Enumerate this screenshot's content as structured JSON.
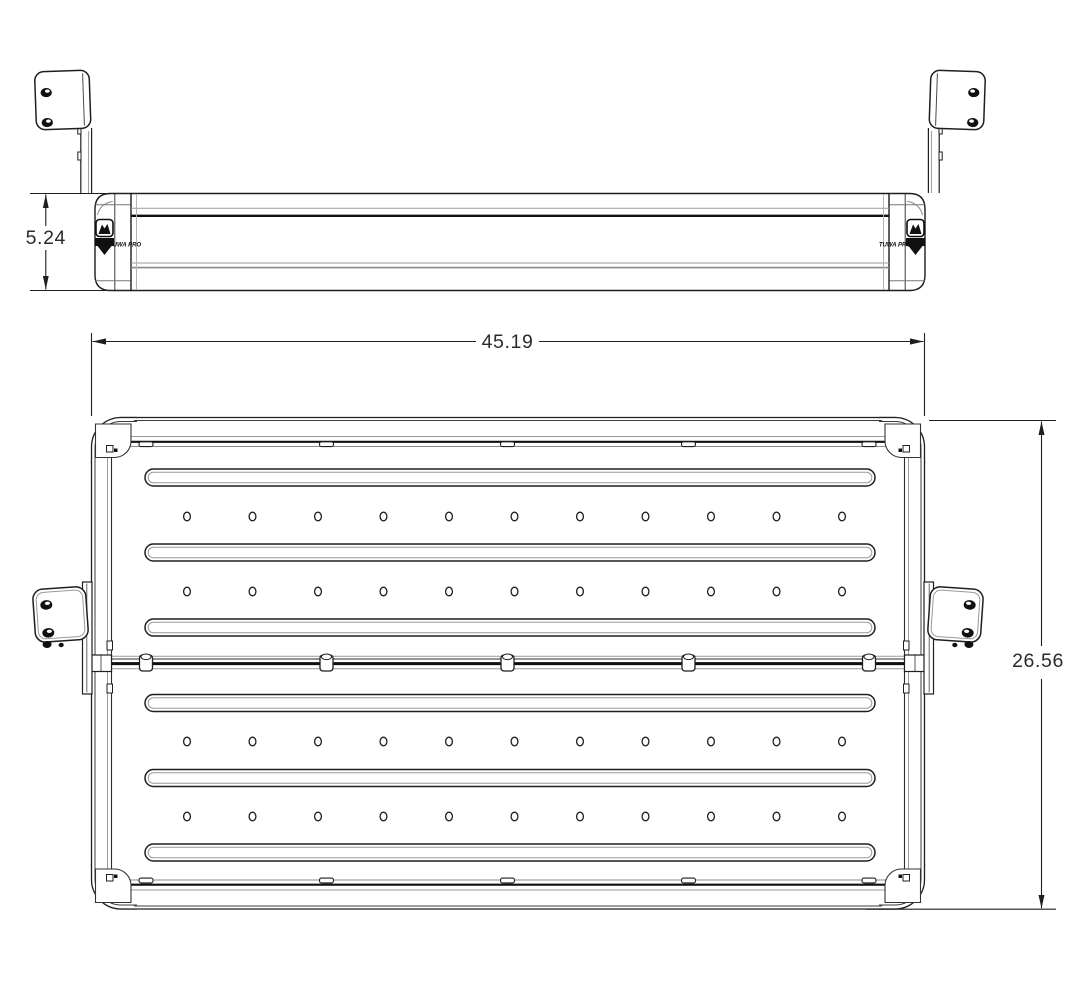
{
  "page": {
    "background_color": "#ffffff"
  },
  "palette": {
    "line": "#1f1f1f",
    "dark_line": "#0f0f0f",
    "light_line": "#9a9a9a",
    "text": "#2b2b2b"
  },
  "dimensions": {
    "crossbar_height_label": "5.24",
    "overall_width_label": "45.19",
    "overall_depth_label": "26.56"
  },
  "brand": {
    "logo_text": "TUWA PRO",
    "logo_icon": "mountain-shield-icon"
  },
  "front_view": {
    "mount_bracket_count": 2,
    "bracket_bolt_hole_count": 2,
    "end_cap_count": 2
  },
  "plan_view": {
    "slot_count": 6,
    "hole_row_count": 4,
    "holes_per_row": 11,
    "seam_clip_count": 5,
    "rail_tab_count": 5,
    "side_bracket_count": 2,
    "side_bracket_bolt_hole_count": 2,
    "corner_count": 4
  }
}
